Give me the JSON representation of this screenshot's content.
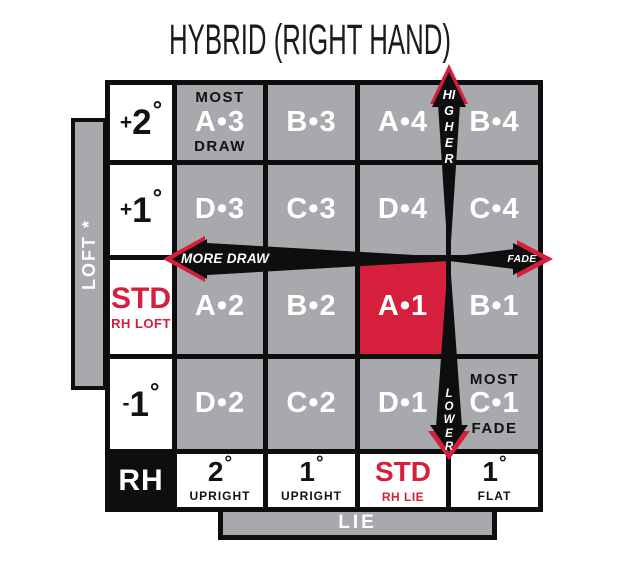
{
  "title": "HYBRID (RIGHT HAND)",
  "axes": {
    "loft": "LOFT *",
    "lie": "LIE"
  },
  "arrows": {
    "higher": "HIGHER",
    "lower": "LOWER",
    "more_draw": "MORE DRAW",
    "fade": "FADE"
  },
  "loft_column": {
    "plus2": {
      "sign": "+",
      "value": "2",
      "degree": "°"
    },
    "plus1": {
      "sign": "+",
      "value": "1",
      "degree": "°"
    },
    "std": {
      "label": "STD",
      "sub": "RH LOFT"
    },
    "minus1": {
      "sign": "-",
      "value": "1",
      "degree": "°"
    }
  },
  "grid": {
    "r1": {
      "c1": {
        "top": "MOST",
        "code": "A•3",
        "bottom": "DRAW"
      },
      "c2": {
        "code": "B•3"
      },
      "c3": {
        "code": "A•4"
      },
      "c4": {
        "code": "B•4"
      }
    },
    "r2": {
      "c1": {
        "code": "D•3"
      },
      "c2": {
        "code": "C•3"
      },
      "c3": {
        "code": "D•4"
      },
      "c4": {
        "code": "C•4"
      }
    },
    "r3": {
      "c1": {
        "code": "A•2"
      },
      "c2": {
        "code": "B•2"
      },
      "c3": {
        "code": "A•1"
      },
      "c4": {
        "code": "B•1"
      }
    },
    "r4": {
      "c1": {
        "code": "D•2"
      },
      "c2": {
        "code": "C•2"
      },
      "c3": {
        "code": "D•1"
      },
      "c4": {
        "top": "MOST",
        "code": "C•1",
        "bottom": "FADE"
      }
    }
  },
  "lie_row": {
    "hand": "RH",
    "upright2": {
      "value": "2",
      "degree": "°",
      "label": "UPRIGHT"
    },
    "upright1": {
      "value": "1",
      "degree": "°",
      "label": "UPRIGHT"
    },
    "std": {
      "label": "STD",
      "sub": "RH LIE"
    },
    "flat1": {
      "value": "1",
      "degree": "°",
      "label": "FLAT"
    }
  },
  "colors": {
    "red": "#d51f3c",
    "gray": "#a7a9ac",
    "black": "#0e0e0e",
    "white": "#ffffff"
  }
}
